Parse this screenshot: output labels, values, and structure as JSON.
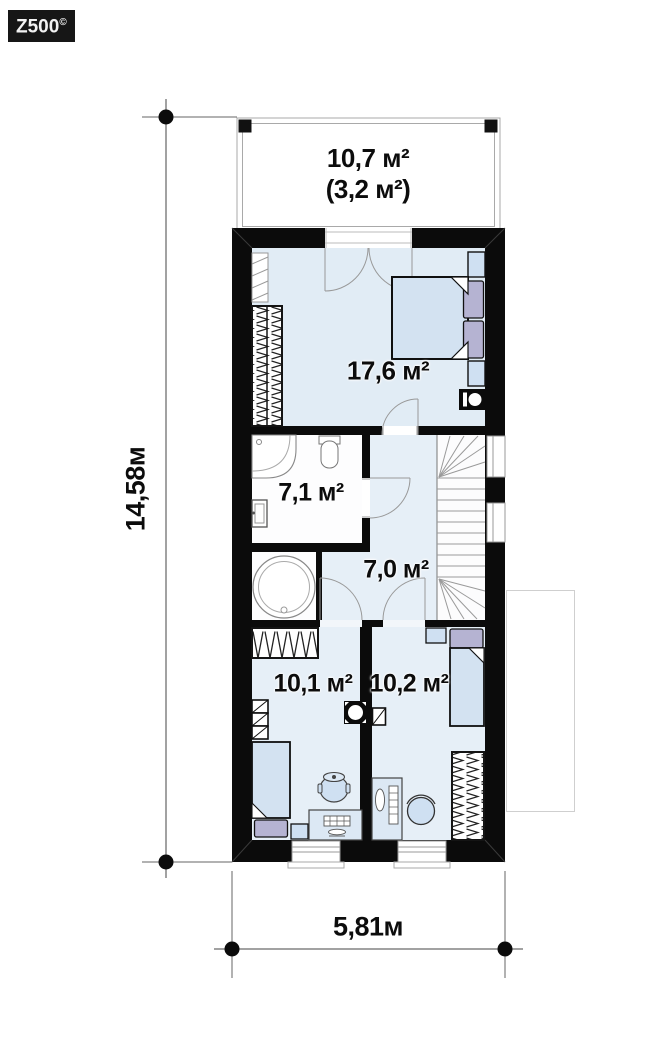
{
  "watermark": {
    "brand": "Z500",
    "copyright": "©"
  },
  "dimensions": {
    "vertical": "14,58м",
    "horizontal": "5,81м"
  },
  "rooms": {
    "balcony": {
      "area": "10,7 м²",
      "area_note": "(3,2 м²)"
    },
    "bedroom": {
      "area": "17,6 м²"
    },
    "bathroom": {
      "area": "7,1 м²"
    },
    "hall": {
      "area": "7,0 м²"
    },
    "child_room_left": {
      "area": "10,1 м²"
    },
    "child_room_right": {
      "area": "10,2 м²"
    }
  },
  "colors": {
    "wall": "#0b0b0b",
    "floor_tint": "#e6eff7",
    "bedroom_floor": "#e1ecf5",
    "furniture_fill": "#d3e2f1",
    "pillow_fill": "#b5b3d2",
    "thin_line": "#999999"
  }
}
